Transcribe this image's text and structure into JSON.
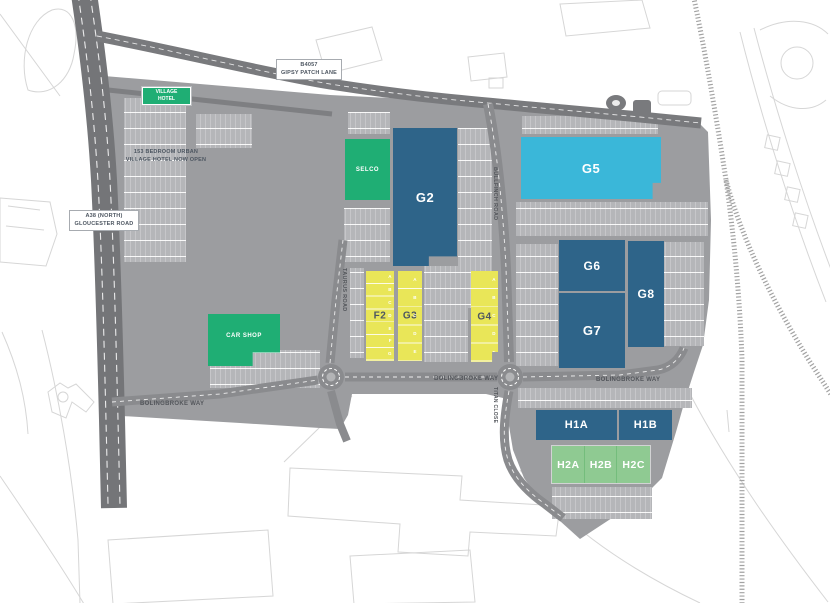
{
  "map": {
    "region_labels": {
      "b4057_line1": "B4057",
      "b4057_line2": "GIPSY PATCH LANE",
      "a38_line1": "A38 (NORTH)",
      "a38_line2": "GLOUCESTER ROAD",
      "hotel_note_line1": "153 BEDROOM URBAN",
      "hotel_note_line2": "VILLAGE HOTEL NOW OPEN"
    },
    "roads": {
      "bolingbroke_way": "BOLINGBROKE WAY",
      "taurus_road": "TAURUS ROAD",
      "bullfinch_road": "BULLFINCH ROAD",
      "titan_close": "TITAN CLOSE"
    },
    "buildings": {
      "village_hotel_line1": "VILLAGE",
      "village_hotel_line2": "HOTEL",
      "selco": "SELCO",
      "car_shop": "CAR SHOP",
      "g2": "G2",
      "g5": "G5",
      "g6": "G6",
      "g7": "G7",
      "g8": "G8",
      "f2": {
        "label": "F2",
        "units": [
          "A",
          "B",
          "C",
          "D",
          "E",
          "F",
          "G"
        ]
      },
      "g3": {
        "label": "G3",
        "units": [
          "A",
          "B",
          "C",
          "D",
          "E"
        ]
      },
      "g4": {
        "label": "G4",
        "units": [
          "A",
          "B",
          "C",
          "D",
          "E"
        ]
      },
      "h1a": "H1A",
      "h1b": "H1B",
      "h2a": "H2A",
      "h2b": "H2B",
      "h2c": "H2C"
    },
    "colors": {
      "unit_blue": "#2e6489",
      "unit_cyan": "#3ab7d9",
      "unit_yellow": "#e9e658",
      "retail_green": "#1fae74",
      "h2_green": "#8fca92",
      "estate_grey": "#9c9da0",
      "parking_grey": "#b5b6b9",
      "road_grey": "#8a8b8e",
      "label_slate": "#4d5661"
    }
  }
}
